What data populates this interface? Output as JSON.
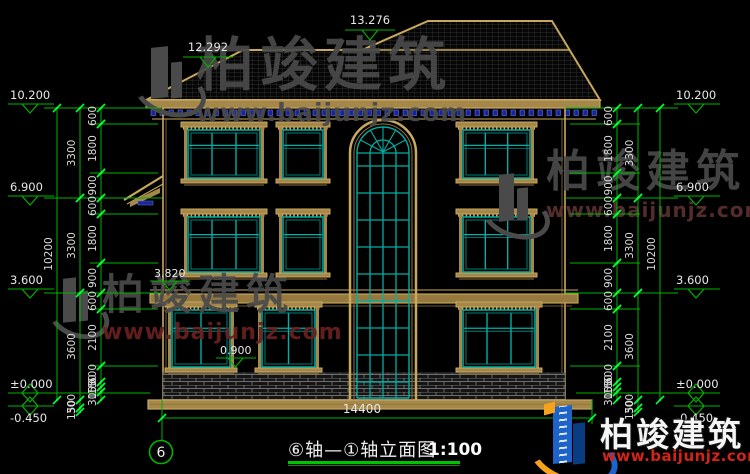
{
  "page": {
    "background": "#000000"
  },
  "colors": {
    "tan": "#c8a85f",
    "tanFill": "#a5874a",
    "tanDark": "#8f7339",
    "teal": "#00afa5",
    "tealDark": "#007f78",
    "green": "#00b400",
    "greenBright": "#00ff30",
    "dimText": "#dcdcdc",
    "dentilBlue": "#16249e",
    "dentilBlueLight": "#6a74d8",
    "brickLine": "#8a8a8a",
    "roofHatch": "#3a3a3a",
    "wmGray": "#4a4a4a",
    "wmRed": "#6b2020",
    "logoBlue": "#1d63c8",
    "logoNavy": "#0a3c82",
    "logoOrange": "#f6a21c",
    "logoRed": "#d42318"
  },
  "title": {
    "text": "⑥轴—①轴立面图",
    "scale": "1:100"
  },
  "overall_dim": {
    "label": "14400"
  },
  "axis_bubble": {
    "label": "6"
  },
  "elevation_markers": {
    "top": [
      {
        "label": "13.276",
        "x": 345,
        "y": 30
      },
      {
        "label": "12.292",
        "x": 183,
        "y": 57
      }
    ],
    "left": [
      {
        "label": "10.200",
        "x": 8,
        "y": 104,
        "type": "down"
      },
      {
        "label": "6.900",
        "x": 8,
        "y": 196,
        "type": "down"
      },
      {
        "label": "3.600",
        "x": 8,
        "y": 289,
        "type": "down"
      },
      {
        "label": "±0.000",
        "x": 8,
        "y": 393,
        "type": "bowtie"
      },
      {
        "label": "-0.450",
        "x": 8,
        "y": 406,
        "type": "bowtie",
        "labelBelow": true
      }
    ],
    "right": [
      {
        "label": "10.200",
        "x": 674,
        "y": 104,
        "type": "down"
      },
      {
        "label": "6.900",
        "x": 674,
        "y": 196,
        "type": "down"
      },
      {
        "label": "3.600",
        "x": 674,
        "y": 289,
        "type": "down"
      },
      {
        "label": "±0.000",
        "x": 674,
        "y": 393,
        "type": "bowtie"
      },
      {
        "label": "-0.450",
        "x": 674,
        "y": 406,
        "type": "bowtie",
        "labelBelow": true
      }
    ],
    "inner": [
      {
        "label": "3.820",
        "x": 150,
        "y": 281
      },
      {
        "label": "0.900",
        "x": 216,
        "y": 358
      }
    ]
  },
  "dim_chains": {
    "left": [
      {
        "x": 57,
        "segs": [
          [
            "10200",
            108,
            400
          ]
        ]
      },
      {
        "x": 80,
        "segs": [
          [
            "3300",
            108,
            198
          ],
          [
            "3300",
            198,
            293
          ],
          [
            "3600",
            293,
            400
          ],
          [
            "300",
            400,
            408
          ],
          [
            "150",
            408,
            412
          ]
        ]
      },
      {
        "x": 101,
        "segs": [
          [
            "600",
            108,
            124
          ],
          [
            "1800",
            124,
            173
          ],
          [
            "900",
            173,
            198
          ],
          [
            "600",
            198,
            214
          ],
          [
            "1800",
            214,
            263
          ],
          [
            "900",
            263,
            293
          ],
          [
            "600",
            293,
            309
          ],
          [
            "2100",
            309,
            366
          ],
          [
            "600",
            366,
            382
          ],
          [
            "150",
            382,
            387
          ],
          [
            "150",
            387,
            392
          ],
          [
            "300",
            392,
            400
          ]
        ]
      }
    ],
    "right": [
      {
        "x": 660,
        "segs": [
          [
            "10200",
            108,
            400
          ]
        ]
      },
      {
        "x": 638,
        "segs": [
          [
            "3300",
            108,
            198
          ],
          [
            "3300",
            198,
            293
          ],
          [
            "3600",
            293,
            400
          ],
          [
            "300",
            400,
            408
          ],
          [
            "150",
            408,
            412
          ]
        ]
      },
      {
        "x": 617,
        "segs": [
          [
            "600",
            108,
            124
          ],
          [
            "1800",
            124,
            173
          ],
          [
            "900",
            173,
            198
          ],
          [
            "600",
            198,
            214
          ],
          [
            "1800",
            214,
            263
          ],
          [
            "900",
            263,
            293
          ],
          [
            "600",
            293,
            309
          ],
          [
            "2100",
            309,
            366
          ],
          [
            "600",
            366,
            382
          ],
          [
            "150",
            382,
            387
          ],
          [
            "150",
            387,
            392
          ],
          [
            "300",
            392,
            400
          ]
        ]
      }
    ]
  },
  "windows": [
    {
      "x": 188,
      "y": 130,
      "w": 72,
      "h": 48,
      "cols": 3
    },
    {
      "x": 283,
      "y": 130,
      "w": 40,
      "h": 48,
      "cols": 1
    },
    {
      "x": 463,
      "y": 130,
      "w": 67,
      "h": 48,
      "cols": 3
    },
    {
      "x": 188,
      "y": 217,
      "w": 72,
      "h": 55,
      "cols": 3
    },
    {
      "x": 283,
      "y": 217,
      "w": 40,
      "h": 55,
      "cols": 1
    },
    {
      "x": 463,
      "y": 217,
      "w": 67,
      "h": 55,
      "cols": 3
    },
    {
      "x": 172,
      "y": 310,
      "w": 58,
      "h": 57,
      "cols": 2
    },
    {
      "x": 262,
      "y": 310,
      "w": 53,
      "h": 57,
      "cols": 2
    },
    {
      "x": 463,
      "y": 310,
      "w": 72,
      "h": 57,
      "cols": 3
    }
  ],
  "watermarks": [
    {
      "brand": "柏竣建筑",
      "url": "www.baijunjz.com",
      "x": 196,
      "y": 36,
      "brandSize": 58,
      "urlSize": 25,
      "urlColor": "#4a4a4a",
      "logoX": 140,
      "logoY": 40,
      "logoW": 52,
      "logoH": 66
    },
    {
      "brand": "柏竣建筑",
      "url": "www.baijunjz.com",
      "x": 102,
      "y": 274,
      "brandSize": 42,
      "urlSize": 22,
      "urlColor": "#6b2020",
      "logoX": 54,
      "logoY": 272,
      "logoW": 42,
      "logoH": 56
    },
    {
      "brand": "柏竣建筑",
      "url": "www.baijunjz.com",
      "x": 546,
      "y": 150,
      "brandSize": 44,
      "urlSize": 20,
      "urlColor": "#5c3030",
      "logoX": 488,
      "logoY": 168,
      "logoW": 48,
      "logoH": 60
    }
  ],
  "logo": {
    "brand": "柏竣建筑",
    "url": "www.baijunjz.com"
  }
}
